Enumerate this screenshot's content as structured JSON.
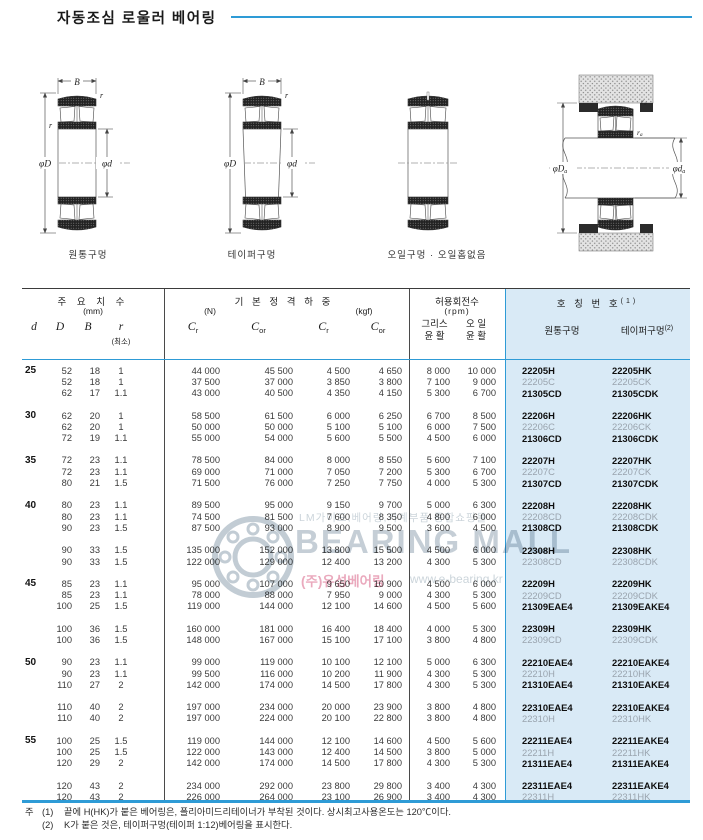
{
  "page": {
    "title": "자동조심 로울러 베어링"
  },
  "diagrams": {
    "caption_cylindrical": "원통구멍",
    "caption_tapered": "테이퍼구멍",
    "caption_oilhole": "오일구멍 · 오일홈없음",
    "dims": {
      "B": "B",
      "r": "r",
      "phiD": "φD",
      "phid": "φd",
      "phiDa_main": "φD",
      "phida_main": "φd",
      "sub_a": "a",
      "ra_main": "r"
    }
  },
  "table": {
    "header": {
      "dims_title": "주 요 치 수",
      "dims_unit": "(mm)",
      "col_d": "d",
      "col_D": "D",
      "col_B": "B",
      "col_r": "r",
      "col_r_min": "(최소)",
      "load_title": "기 본 정 격 하 중",
      "load_unit_n": "(N)",
      "load_unit_kgf": "(kgf)",
      "c_sym": "C",
      "sub_r": "r",
      "sub_or": "or",
      "speed_title": "허용회전수",
      "speed_unit": "(rpm)",
      "grease_l1": "그리스",
      "grease_l2": "윤 활",
      "oil_l1": "오 일",
      "oil_l2": "윤 활",
      "name_title": "호 칭 번 호",
      "name_sup": "(1)",
      "name_cyl": "원통구멍",
      "name_taper": "테이퍼구멍",
      "taper_sup": "(2)"
    },
    "groups": [
      {
        "d": "25",
        "rows": [
          {
            "D": "52",
            "B": "18",
            "r": "1",
            "crN": "44 000",
            "corN": "45 500",
            "crK": "4 500",
            "corK": "4 650",
            "grease": "8 000",
            "oil": "10 000",
            "cyl": "22205H",
            "taper": "22205HK",
            "strong": true
          },
          {
            "D": "52",
            "B": "18",
            "r": "1",
            "crN": "37 500",
            "corN": "37 000",
            "crK": "3 850",
            "corK": "3 800",
            "grease": "7 100",
            "oil": "9 000",
            "cyl": "22205C",
            "taper": "22205CK",
            "strong": false
          },
          {
            "D": "62",
            "B": "17",
            "r": "1.1",
            "crN": "43 000",
            "corN": "40 500",
            "crK": "4 350",
            "corK": "4 150",
            "grease": "5 300",
            "oil": "6 700",
            "cyl": "21305CD",
            "taper": "21305CDK",
            "strong": true
          }
        ]
      },
      {
        "d": "30",
        "rows": [
          {
            "D": "62",
            "B": "20",
            "r": "1",
            "crN": "58 500",
            "corN": "61 500",
            "crK": "6 000",
            "corK": "6 250",
            "grease": "6 700",
            "oil": "8 500",
            "cyl": "22206H",
            "taper": "22206HK",
            "strong": true
          },
          {
            "D": "62",
            "B": "20",
            "r": "1",
            "crN": "50 000",
            "corN": "50 000",
            "crK": "5 100",
            "corK": "5 100",
            "grease": "6 000",
            "oil": "7 500",
            "cyl": "22206C",
            "taper": "22206CK",
            "strong": false
          },
          {
            "D": "72",
            "B": "19",
            "r": "1.1",
            "crN": "55 000",
            "corN": "54 000",
            "crK": "5 600",
            "corK": "5 500",
            "grease": "4 500",
            "oil": "6 000",
            "cyl": "21306CD",
            "taper": "21306CDK",
            "strong": true
          }
        ]
      },
      {
        "d": "35",
        "rows": [
          {
            "D": "72",
            "B": "23",
            "r": "1.1",
            "crN": "78 500",
            "corN": "84 000",
            "crK": "8 000",
            "corK": "8 550",
            "grease": "5 600",
            "oil": "7 100",
            "cyl": "22207H",
            "taper": "22207HK",
            "strong": true
          },
          {
            "D": "72",
            "B": "23",
            "r": "1.1",
            "crN": "69 000",
            "corN": "71 000",
            "crK": "7 050",
            "corK": "7 200",
            "grease": "5 300",
            "oil": "6 700",
            "cyl": "22207C",
            "taper": "22207CK",
            "strong": false
          },
          {
            "D": "80",
            "B": "21",
            "r": "1.5",
            "crN": "71 500",
            "corN": "76 000",
            "crK": "7 250",
            "corK": "7 750",
            "grease": "4 000",
            "oil": "5 300",
            "cyl": "21307CD",
            "taper": "21307CDK",
            "strong": true
          }
        ]
      },
      {
        "d": "40",
        "rows": [
          {
            "D": "80",
            "B": "23",
            "r": "1.1",
            "crN": "89 500",
            "corN": "95 000",
            "crK": "9 150",
            "corK": "9 700",
            "grease": "5 000",
            "oil": "6 300",
            "cyl": "22208H",
            "taper": "22208HK",
            "strong": true
          },
          {
            "D": "80",
            "B": "23",
            "r": "1.1",
            "crN": "74 500",
            "corN": "81 500",
            "crK": "7 600",
            "corK": "8 350",
            "grease": "4 800",
            "oil": "6 000",
            "cyl": "22208CD",
            "taper": "22208CDK",
            "strong": false
          },
          {
            "D": "90",
            "B": "23",
            "r": "1.5",
            "crN": "87 500",
            "corN": "93 000",
            "crK": "8 900",
            "corK": "9 500",
            "grease": "3 600",
            "oil": "4 500",
            "cyl": "21308CD",
            "taper": "21308CDK",
            "strong": true
          }
        ],
        "sub": [
          {
            "D": "90",
            "B": "33",
            "r": "1.5",
            "crN": "135 000",
            "corN": "152 000",
            "crK": "13 800",
            "corK": "15 500",
            "grease": "4 500",
            "oil": "6 000",
            "cyl": "22308H",
            "taper": "22308HK",
            "strong": true
          },
          {
            "D": "90",
            "B": "33",
            "r": "1.5",
            "crN": "122 000",
            "corN": "129 000",
            "crK": "12 400",
            "corK": "13 200",
            "grease": "4 300",
            "oil": "5 300",
            "cyl": "22308CD",
            "taper": "22308CDK",
            "strong": false
          }
        ]
      },
      {
        "d": "45",
        "rows": [
          {
            "D": "85",
            "B": "23",
            "r": "1.1",
            "crN": "95 000",
            "corN": "107 000",
            "crK": "9 650",
            "corK": "10 900",
            "grease": "4 500",
            "oil": "6 000",
            "cyl": "22209H",
            "taper": "22209HK",
            "strong": true
          },
          {
            "D": "85",
            "B": "23",
            "r": "1.1",
            "crN": "78 000",
            "corN": "88 000",
            "crK": "7 950",
            "corK": "9 000",
            "grease": "4 300",
            "oil": "5 300",
            "cyl": "22209CD",
            "taper": "22209CDK",
            "strong": false
          },
          {
            "D": "100",
            "B": "25",
            "r": "1.5",
            "crN": "119 000",
            "corN": "144 000",
            "crK": "12 100",
            "corK": "14 600",
            "grease": "4 500",
            "oil": "5 600",
            "cyl": "21309EAE4",
            "taper": "21309EAKE4",
            "strong": true
          }
        ],
        "sub": [
          {
            "D": "100",
            "B": "36",
            "r": "1.5",
            "crN": "160 000",
            "corN": "181 000",
            "crK": "16 400",
            "corK": "18 400",
            "grease": "4 000",
            "oil": "5 300",
            "cyl": "22309H",
            "taper": "22309HK",
            "strong": true
          },
          {
            "D": "100",
            "B": "36",
            "r": "1.5",
            "crN": "148 000",
            "corN": "167 000",
            "crK": "15 100",
            "corK": "17 100",
            "grease": "3 800",
            "oil": "4 800",
            "cyl": "22309CD",
            "taper": "22309CDK",
            "strong": false
          }
        ]
      },
      {
        "d": "50",
        "rows": [
          {
            "D": "90",
            "B": "23",
            "r": "1.1",
            "crN": "99 000",
            "corN": "119 000",
            "crK": "10 100",
            "corK": "12 100",
            "grease": "5 000",
            "oil": "6 300",
            "cyl": "22210EAE4",
            "taper": "22210EAKE4",
            "strong": true
          },
          {
            "D": "90",
            "B": "23",
            "r": "1.1",
            "crN": "99 500",
            "corN": "116 000",
            "crK": "10 200",
            "corK": "11 900",
            "grease": "4 300",
            "oil": "5 300",
            "cyl": "22210H",
            "taper": "22210HK",
            "strong": false
          },
          {
            "D": "110",
            "B": "27",
            "r": "2",
            "crN": "142 000",
            "corN": "174 000",
            "crK": "14 500",
            "corK": "17 800",
            "grease": "4 300",
            "oil": "5 300",
            "cyl": "21310EAE4",
            "taper": "21310EAKE4",
            "strong": true
          }
        ],
        "sub": [
          {
            "D": "110",
            "B": "40",
            "r": "2",
            "crN": "197 000",
            "corN": "234 000",
            "crK": "20 000",
            "corK": "23 900",
            "grease": "3 800",
            "oil": "4 800",
            "cyl": "22310EAE4",
            "taper": "22310EAKE4",
            "strong": true
          },
          {
            "D": "110",
            "B": "40",
            "r": "2",
            "crN": "197 000",
            "corN": "224 000",
            "crK": "20 100",
            "corK": "22 800",
            "grease": "3 800",
            "oil": "4 800",
            "cyl": "22310H",
            "taper": "22310HK",
            "strong": false
          }
        ]
      },
      {
        "d": "55",
        "rows": [
          {
            "D": "100",
            "B": "25",
            "r": "1.5",
            "crN": "119 000",
            "corN": "144 000",
            "crK": "12 100",
            "corK": "14 600",
            "grease": "4 500",
            "oil": "5 600",
            "cyl": "22211EAE4",
            "taper": "22211EAKE4",
            "strong": true
          },
          {
            "D": "100",
            "B": "25",
            "r": "1.5",
            "crN": "122 000",
            "corN": "143 000",
            "crK": "12 400",
            "corK": "14 500",
            "grease": "3 800",
            "oil": "5 000",
            "cyl": "22211H",
            "taper": "22211HK",
            "strong": false
          },
          {
            "D": "120",
            "B": "29",
            "r": "2",
            "crN": "142 000",
            "corN": "174 000",
            "crK": "14 500",
            "corK": "17 800",
            "grease": "4 300",
            "oil": "5 300",
            "cyl": "21311EAE4",
            "taper": "21311EAKE4",
            "strong": true
          }
        ],
        "sub": [
          {
            "D": "120",
            "B": "43",
            "r": "2",
            "crN": "234 000",
            "corN": "292 000",
            "crK": "23 800",
            "corK": "29 800",
            "grease": "3 400",
            "oil": "4 300",
            "cyl": "22311EAE4",
            "taper": "22311EAKE4",
            "strong": true
          },
          {
            "D": "120",
            "B": "43",
            "r": "2",
            "crN": "226 000",
            "corN": "264 000",
            "crK": "23 100",
            "corK": "26 900",
            "grease": "3 400",
            "oil": "4 300",
            "cyl": "22311H",
            "taper": "22311HK",
            "strong": false
          }
        ]
      }
    ]
  },
  "footnotes": {
    "prefix": "주",
    "line1_num": "(1)",
    "line1_text": "끝에 H(HK)가 붙은 베어링은, 폴리아미드리테이너가 부착된 것이다. 상시최고사용온도는 120℃이다.",
    "line2_num": "(2)",
    "line2_text": "K가 붙은 것은, 테이퍼구멍(테이퍼 1:12)베어링을 표시한다."
  },
  "watermark": {
    "line1": "LM가이드,베어링,기계부품 종합쇼핑몰",
    "line2": "BEARING MALL",
    "line3_pink": "(주)유성베어링",
    "line3_gray": "www.e-bearing.kr"
  },
  "colors": {
    "accent_blue": "#2e9bd6",
    "panel_blue": "#d9eaf6",
    "muted_designation": "#9aa4ae",
    "watermark_gray": "#c5ced6",
    "watermark_pink": "#eaa9bd"
  }
}
